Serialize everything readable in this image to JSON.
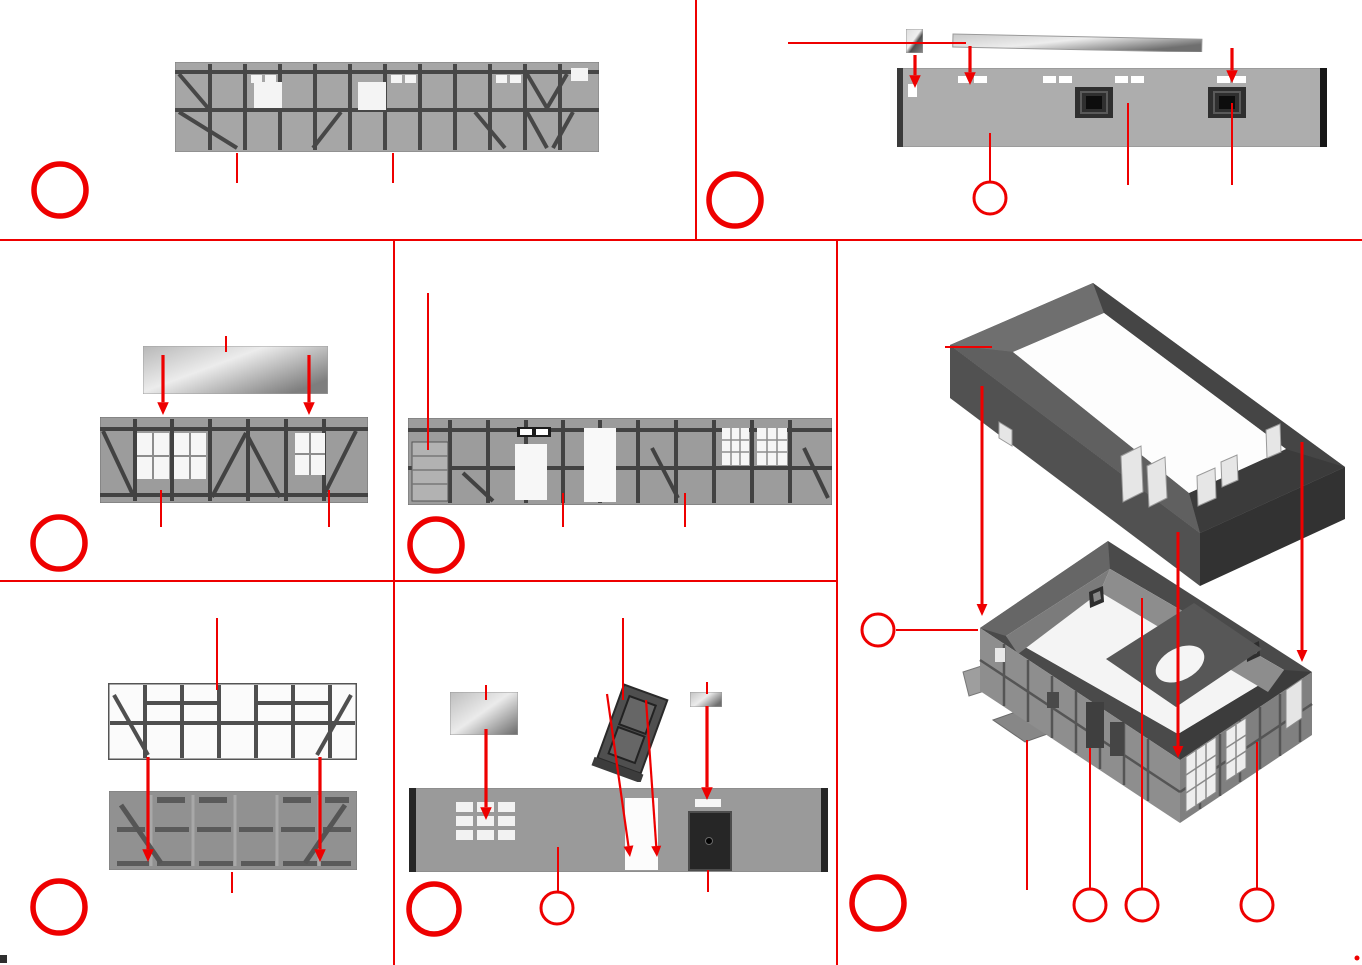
{
  "canvas": {
    "width": 1362,
    "height": 965,
    "background": "#ffffff"
  },
  "colors": {
    "accent": "#ee0000",
    "paper": "#ffffff",
    "photo_gray": "#a6a6a6",
    "dark_plastic": "#4a4a4a"
  },
  "sheet": {
    "kind": "model-kit-assembly-instruction-diagram",
    "visible_text": "",
    "note": "image-only scanned instruction sheet; all step circles are empty (no printed numbers visible)"
  },
  "panels": [
    {
      "id": "top-left",
      "bounds": [
        0,
        0,
        696,
        240
      ],
      "step_label": "",
      "parts": [
        {
          "name": "upper-wall-strip-photo",
          "desc": "half-timbered upper wall strip with window openings"
        }
      ]
    },
    {
      "id": "top-right",
      "bounds": [
        696,
        0,
        666,
        240
      ],
      "step_label": "",
      "parts": [
        {
          "name": "small-glazing-pane",
          "desc": "small clear glazing piece"
        },
        {
          "name": "glazing-strip",
          "desc": "long clear glazing strip"
        },
        {
          "name": "rear-wall-photo",
          "desc": "rear wall piece with slot openings and two dark window frames"
        }
      ]
    },
    {
      "id": "middle-left",
      "bounds": [
        0,
        240,
        394,
        341
      ],
      "step_label": "",
      "parts": [
        {
          "name": "glazing-strip",
          "desc": "clear glazing strip"
        },
        {
          "name": "gable-wall-photo",
          "desc": "half-timbered wall with three lattice windows and diagonal braces"
        }
      ]
    },
    {
      "id": "middle-center",
      "bounds": [
        394,
        240,
        443,
        341
      ],
      "step_label": "",
      "parts": [
        {
          "name": "long-wall-photo",
          "desc": "long half-timbered wall with plank door, two door openings and two lattice windows"
        }
      ]
    },
    {
      "id": "bottom-left",
      "bounds": [
        0,
        581,
        394,
        384
      ],
      "step_label": "",
      "parts": [
        {
          "name": "timber-frame-photo",
          "desc": "open timber framework piece"
        },
        {
          "name": "rear-wall-panel-photo",
          "desc": "embossed rear wall panel"
        }
      ]
    },
    {
      "id": "bottom-center",
      "bounds": [
        394,
        581,
        443,
        384
      ],
      "step_label": "",
      "parts": [
        {
          "name": "glazing-pane",
          "desc": "clear glazing pane"
        },
        {
          "name": "door-leaf-piece",
          "desc": "panelled door leaf shown tilted"
        },
        {
          "name": "small-glazing-pane",
          "desc": "small clear glazing strip"
        },
        {
          "name": "entrance-wall-photo",
          "desc": "wall with nine-pane window grid, doorway opening and dark door"
        }
      ]
    },
    {
      "id": "right-assembly",
      "bounds": [
        837,
        240,
        525,
        725
      ],
      "step_label": "",
      "parts": [
        {
          "name": "upper-storey-assembly-photo",
          "desc": "assembled upper storey wall ring, isometric view"
        },
        {
          "name": "ground-floor-assembly-photo",
          "desc": "assembled ground floor with base plates, floor hole and half-timbered walls, isometric view"
        }
      ]
    }
  ],
  "annotations": {
    "dividers": [
      [
        696,
        0,
        696,
        240
      ],
      [
        0,
        240,
        1362,
        240
      ],
      [
        394,
        240,
        394,
        965
      ],
      [
        837,
        240,
        837,
        965
      ],
      [
        0,
        581,
        837,
        581
      ]
    ],
    "step_markers": [
      {
        "cx": 60,
        "cy": 190,
        "r": 26,
        "sw": 5.5,
        "label": ""
      },
      {
        "cx": 735,
        "cy": 200,
        "r": 26,
        "sw": 5.5,
        "label": ""
      },
      {
        "cx": 59,
        "cy": 543,
        "r": 26,
        "sw": 5.5,
        "label": ""
      },
      {
        "cx": 436,
        "cy": 545,
        "r": 26,
        "sw": 5.5,
        "label": ""
      },
      {
        "cx": 59,
        "cy": 907,
        "r": 26,
        "sw": 5.5,
        "label": ""
      },
      {
        "cx": 434,
        "cy": 909,
        "r": 25,
        "sw": 5.5,
        "label": ""
      },
      {
        "cx": 878,
        "cy": 903,
        "r": 26,
        "sw": 5.5,
        "label": ""
      }
    ],
    "callout_markers": [
      {
        "cx": 990,
        "cy": 198,
        "r": 16,
        "sw": 3,
        "label": ""
      },
      {
        "cx": 557,
        "cy": 908,
        "r": 16,
        "sw": 3,
        "label": ""
      },
      {
        "cx": 878,
        "cy": 630,
        "r": 16,
        "sw": 3,
        "label": ""
      },
      {
        "cx": 1090,
        "cy": 905,
        "r": 16,
        "sw": 3,
        "label": ""
      },
      {
        "cx": 1142,
        "cy": 905,
        "r": 16,
        "sw": 3,
        "label": ""
      },
      {
        "cx": 1257,
        "cy": 905,
        "r": 16,
        "sw": 3,
        "label": ""
      }
    ],
    "leader_lines": [
      [
        237,
        153,
        237,
        183
      ],
      [
        393,
        153,
        393,
        183
      ],
      [
        788,
        43,
        966,
        43
      ],
      [
        990,
        133,
        990,
        181
      ],
      [
        1128,
        103,
        1128,
        185
      ],
      [
        1232,
        103,
        1232,
        185
      ],
      [
        226,
        336,
        226,
        352
      ],
      [
        161,
        490,
        161,
        527
      ],
      [
        329,
        490,
        329,
        527
      ],
      [
        428,
        293,
        428,
        450
      ],
      [
        563,
        493,
        563,
        527
      ],
      [
        685,
        493,
        685,
        527
      ],
      [
        217,
        618,
        217,
        690
      ],
      [
        232,
        872,
        232,
        893
      ],
      [
        486,
        685,
        486,
        700
      ],
      [
        623,
        618,
        623,
        700
      ],
      [
        707,
        682,
        707,
        694
      ],
      [
        558,
        847,
        558,
        891
      ],
      [
        708,
        870,
        708,
        892
      ],
      [
        945,
        347,
        992,
        347
      ],
      [
        896,
        630,
        978,
        630
      ],
      [
        1027,
        740,
        1027,
        890
      ],
      [
        1090,
        748,
        1090,
        888
      ],
      [
        1142,
        598,
        1142,
        888
      ],
      [
        1257,
        742,
        1257,
        888
      ]
    ],
    "arrows": [
      {
        "x1": 915,
        "y1": 55,
        "x2": 915,
        "y2": 88,
        "w": 3.2
      },
      {
        "x1": 970,
        "y1": 46,
        "x2": 970,
        "y2": 85,
        "w": 3.2
      },
      {
        "x1": 1232,
        "y1": 48,
        "x2": 1232,
        "y2": 83,
        "w": 3.2
      },
      {
        "x1": 163,
        "y1": 355,
        "x2": 163,
        "y2": 415,
        "w": 3.2
      },
      {
        "x1": 309,
        "y1": 355,
        "x2": 309,
        "y2": 415,
        "w": 3.2
      },
      {
        "x1": 148,
        "y1": 757,
        "x2": 148,
        "y2": 862,
        "w": 3.2
      },
      {
        "x1": 320,
        "y1": 757,
        "x2": 320,
        "y2": 862,
        "w": 3.2
      },
      {
        "x1": 486,
        "y1": 729,
        "x2": 486,
        "y2": 820,
        "w": 3.2
      },
      {
        "x1": 607,
        "y1": 694,
        "x2": 630,
        "y2": 857,
        "w": 2.2
      },
      {
        "x1": 646,
        "y1": 700,
        "x2": 657,
        "y2": 857,
        "w": 2.2
      },
      {
        "x1": 707,
        "y1": 706,
        "x2": 707,
        "y2": 800,
        "w": 3.2
      },
      {
        "x1": 982,
        "y1": 386,
        "x2": 982,
        "y2": 616,
        "w": 3.0
      },
      {
        "x1": 1178,
        "y1": 532,
        "x2": 1178,
        "y2": 758,
        "w": 3.0
      },
      {
        "x1": 1302,
        "y1": 442,
        "x2": 1302,
        "y2": 662,
        "w": 3.0
      }
    ],
    "dots": [
      [
        1357,
        958,
        2.5
      ]
    ]
  }
}
